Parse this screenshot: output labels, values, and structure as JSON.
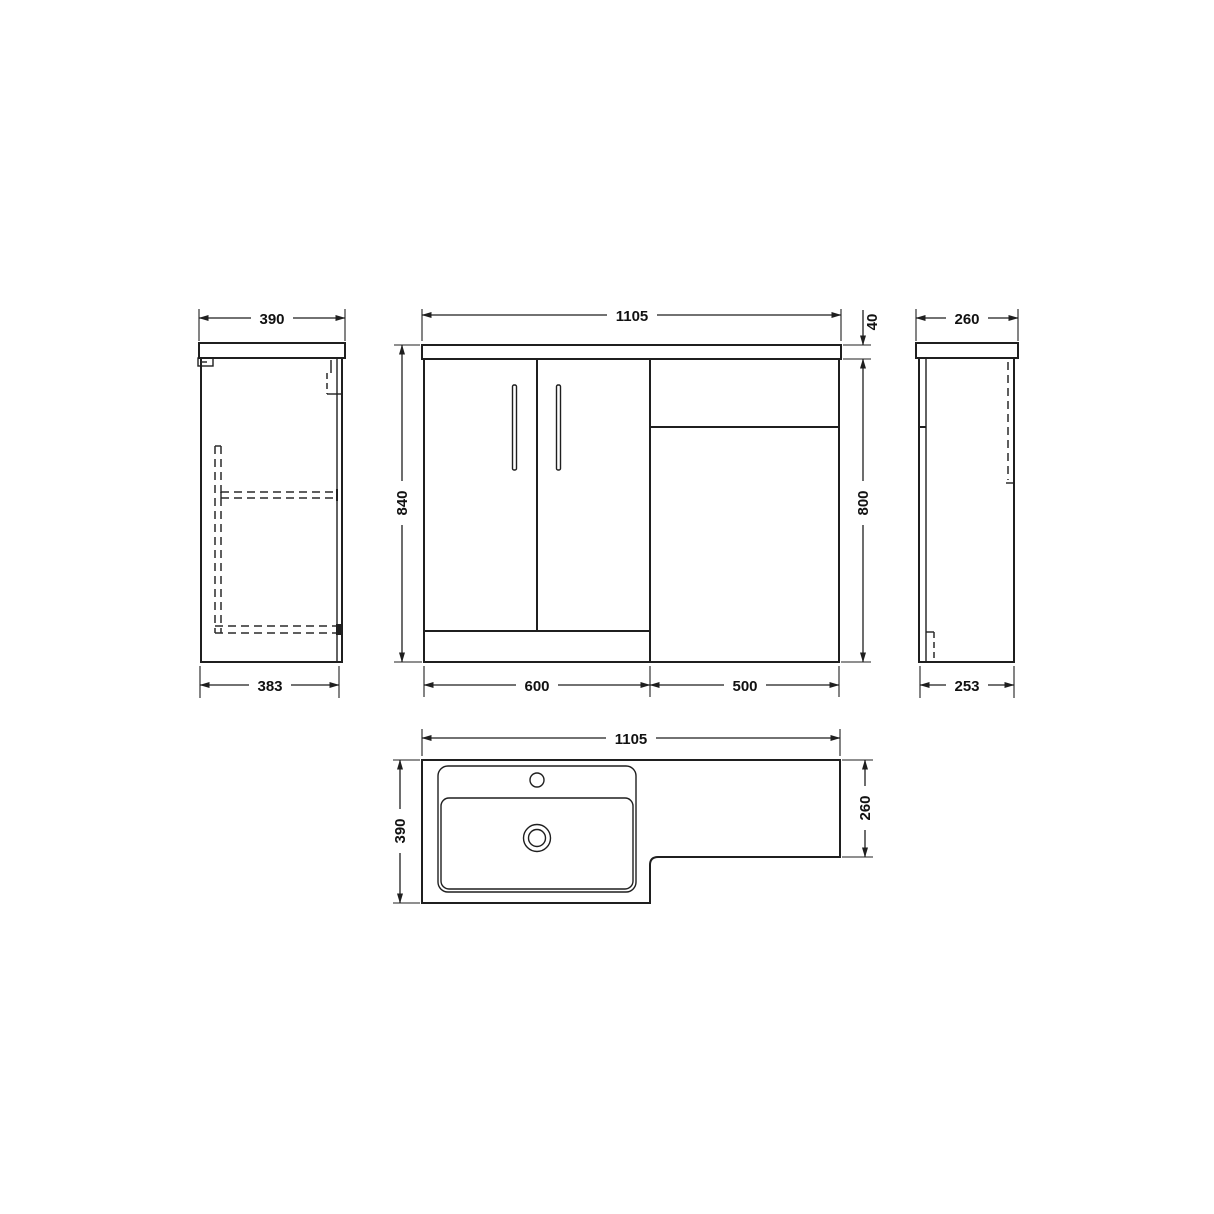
{
  "colors": {
    "line": "#1f1f1f",
    "background": "#ffffff"
  },
  "views": {
    "left_side": {
      "dims": {
        "top_width": "390",
        "bottom_width": "383"
      }
    },
    "front": {
      "dims": {
        "width": "1105",
        "total_height": "840",
        "worktop_thickness": "40",
        "unit_height": "800",
        "vanity_width": "600",
        "wc_unit_width": "500"
      }
    },
    "right_side": {
      "dims": {
        "top_depth": "260",
        "bottom_depth": "253"
      }
    },
    "plan": {
      "dims": {
        "width": "1105",
        "basin_depth": "390",
        "wc_depth": "260"
      }
    }
  }
}
